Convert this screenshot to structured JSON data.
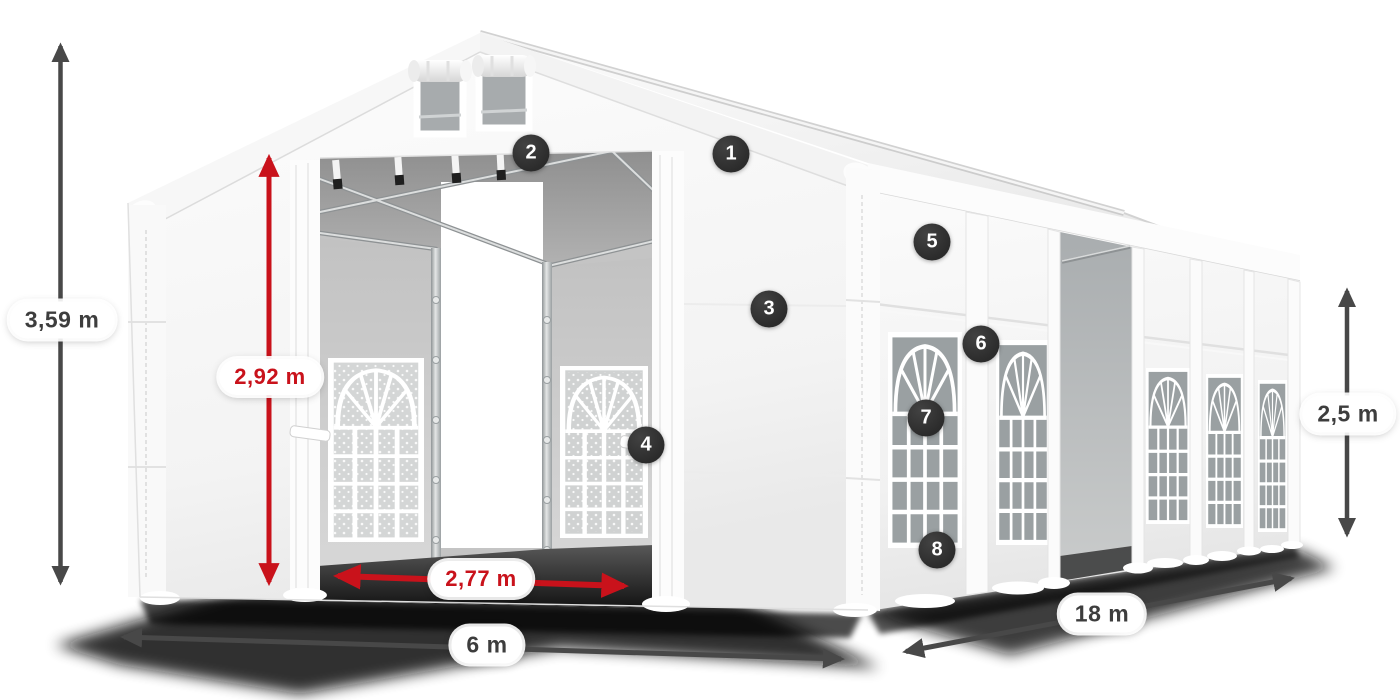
{
  "figure": {
    "title": "Marquee tent dimension diagram",
    "background": "#ffffff"
  },
  "dimensions": [
    {
      "id": "total_height",
      "label": "3,59 m",
      "style": "dark",
      "orientation": "vertical"
    },
    {
      "id": "entrance_height",
      "label": "2,92 m",
      "style": "red",
      "orientation": "vertical"
    },
    {
      "id": "entrance_width",
      "label": "2,77 m",
      "style": "red",
      "orientation": "horizontal"
    },
    {
      "id": "front_width",
      "label": "6 m",
      "style": "dark",
      "orientation": "horizontal"
    },
    {
      "id": "side_length",
      "label": "18 m",
      "style": "dark",
      "orientation": "diagonal"
    },
    {
      "id": "side_wall_height",
      "label": "2,5 m",
      "style": "dark",
      "orientation": "vertical"
    }
  ],
  "callouts": [
    {
      "number": "1"
    },
    {
      "number": "2"
    },
    {
      "number": "3"
    },
    {
      "number": "4"
    },
    {
      "number": "5"
    },
    {
      "number": "6"
    },
    {
      "number": "7"
    },
    {
      "number": "8"
    }
  ],
  "colors": {
    "red_accent": "#c9121b",
    "arrow_dark": "#484848",
    "label_text": "#3d3d3d",
    "badge_bg": "#2b2b2b",
    "badge_text": "#ffffff",
    "pill_bg": "#ffffff"
  }
}
